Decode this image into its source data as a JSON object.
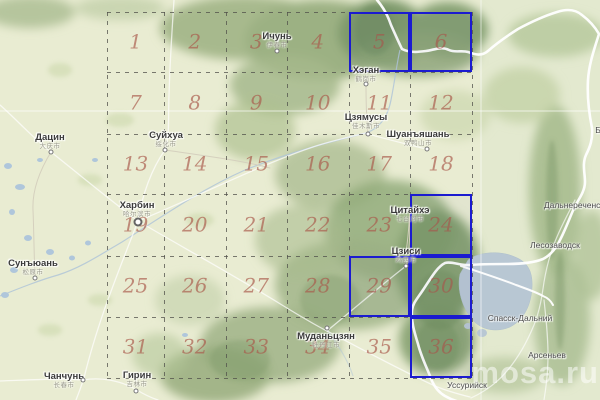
{
  "map": {
    "watermark": "mosa.ru",
    "colors": {
      "base": "#e9ecd2",
      "water": "#b8c7d3",
      "small_lake": "#a9c3dc",
      "grid_line": "#50504a",
      "grid_number": "rgba(170,90,75,0.68)",
      "highlight": "#1b1bd0",
      "city_label": "#3a3a3a",
      "town_label": "#4c4c4c",
      "cn_label": "#98988a",
      "border_line": "#ffffff"
    },
    "grid": {
      "col_x": [
        107,
        164,
        225.5,
        287,
        348.5,
        410,
        472
      ],
      "row_y": [
        11.5,
        72,
        133.5,
        194,
        255.5,
        316.5,
        377.5
      ],
      "numbers": [
        1,
        2,
        3,
        4,
        5,
        6,
        7,
        8,
        9,
        10,
        11,
        12,
        13,
        14,
        15,
        16,
        17,
        18,
        19,
        20,
        21,
        22,
        23,
        24,
        25,
        26,
        27,
        28,
        29,
        30,
        31,
        32,
        33,
        34,
        35,
        36
      ],
      "highlighted": [
        5,
        6,
        24,
        29,
        30,
        36
      ]
    },
    "cities": [
      {
        "name": "Дацин",
        "cn": "大庆市",
        "x": 50,
        "y": 138,
        "marker": {
          "x": 51,
          "y": 152,
          "type": "dot"
        }
      },
      {
        "name": "Ичунь",
        "cn": "伊春市",
        "x": 277,
        "y": 37,
        "marker": {
          "x": 277,
          "y": 51,
          "type": "dot"
        }
      },
      {
        "name": "Суйхуа",
        "cn": "绥化市",
        "x": 166,
        "y": 136,
        "marker": {
          "x": 165,
          "y": 150,
          "type": "dot"
        }
      },
      {
        "name": "Хэган",
        "cn": "鹤岗市",
        "x": 366,
        "y": 71,
        "marker": {
          "x": 366,
          "y": 84,
          "type": "dot"
        }
      },
      {
        "name": "Цзямусы",
        "cn": "佳木斯市",
        "x": 366,
        "y": 118,
        "marker": {
          "x": 368,
          "y": 134,
          "type": "dot"
        }
      },
      {
        "name": "Шуанъяшань",
        "cn": "双鸭山市",
        "x": 418,
        "y": 135,
        "marker": {
          "x": 427,
          "y": 149,
          "type": "dot"
        }
      },
      {
        "name": "Харбин",
        "cn": "哈尔滨市",
        "x": 137,
        "y": 206,
        "marker": {
          "x": 138,
          "y": 222,
          "type": "ring"
        }
      },
      {
        "name": "Цитайхэ",
        "cn": "七台河市",
        "x": 410,
        "y": 211,
        "marker": null
      },
      {
        "name": "Цзиси",
        "cn": "鸡西市",
        "x": 406,
        "y": 252,
        "marker": {
          "x": 406,
          "y": 266,
          "type": "dot"
        }
      },
      {
        "name": "Муданьцзян",
        "cn": "牡丹江市",
        "x": 326,
        "y": 337,
        "marker": {
          "x": 327,
          "y": 328,
          "type": "dot"
        }
      },
      {
        "name": "Сунъюань",
        "cn": "松原市",
        "x": 33,
        "y": 264,
        "marker": {
          "x": 35,
          "y": 278,
          "type": "dot"
        }
      },
      {
        "name": "Чанчунь",
        "cn": "长春市",
        "x": 64,
        "y": 377,
        "marker": {
          "x": 83,
          "y": 380,
          "type": "dot"
        }
      },
      {
        "name": "Гирин",
        "cn": "吉林市",
        "x": 137,
        "y": 376,
        "marker": {
          "x": 136,
          "y": 391,
          "type": "dot"
        }
      }
    ],
    "towns": [
      {
        "name": "Дальнереченск",
        "x": 574,
        "y": 205
      },
      {
        "name": "Лесозаводск",
        "x": 555,
        "y": 245
      },
      {
        "name": "Спасск-Дальний",
        "x": 520,
        "y": 318
      },
      {
        "name": "Арсеньев",
        "x": 547,
        "y": 355
      },
      {
        "name": "Уссурийск",
        "x": 467,
        "y": 385
      },
      {
        "name": "Б",
        "x": 598,
        "y": 130
      }
    ]
  }
}
